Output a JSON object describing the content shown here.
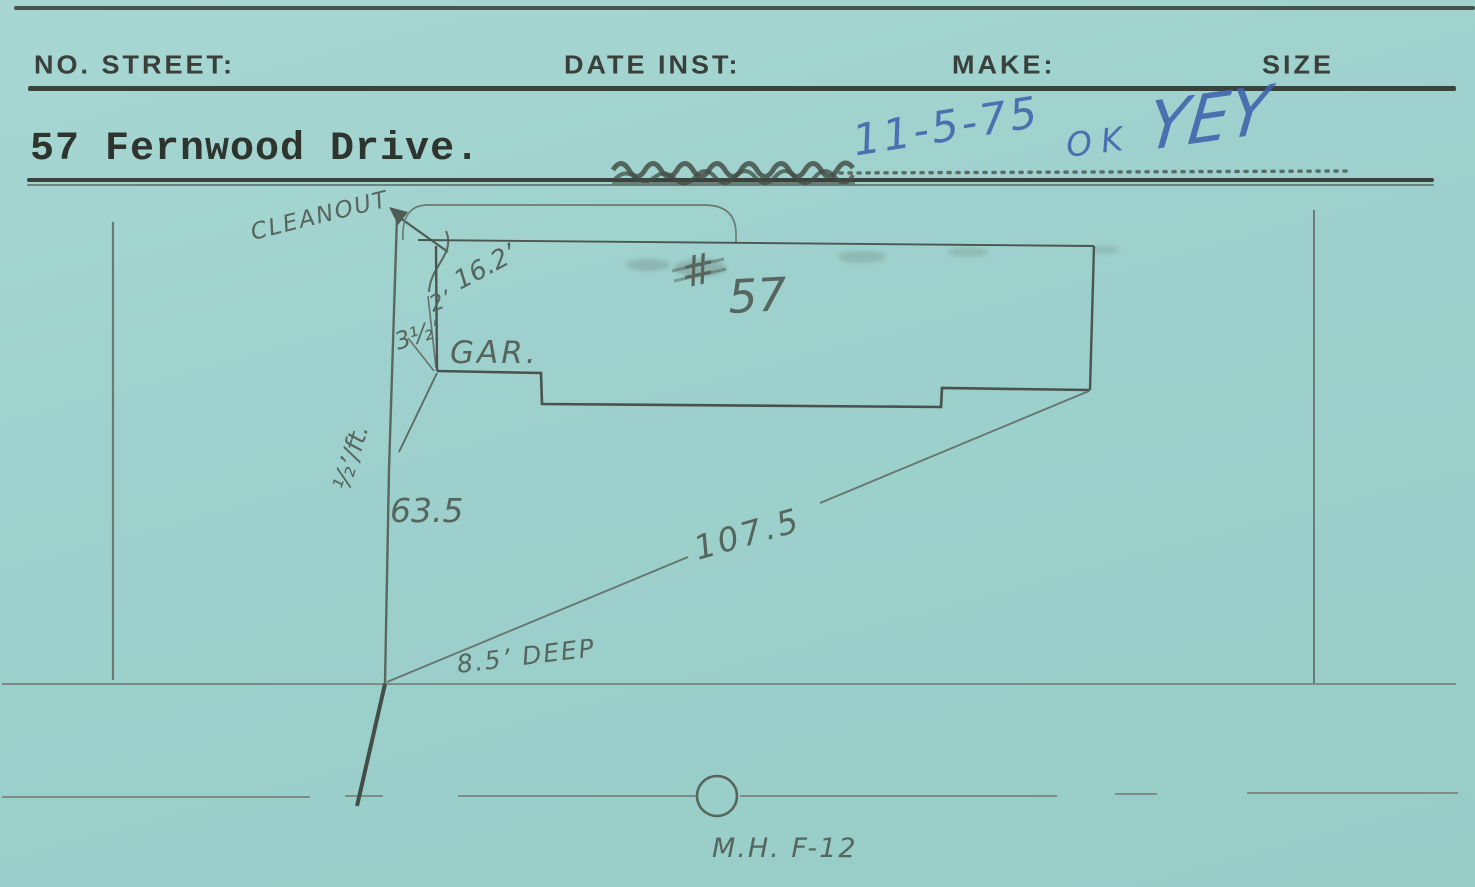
{
  "colors": {
    "card_bg": "#9ed1cd",
    "printed_ink": "#39403a",
    "pencil": "#5c6b63",
    "pencil_dark": "#49554e",
    "blue_pen": "#3f63ac"
  },
  "header": {
    "no_street": "NO. STREET:",
    "date_inst": "DATE INST:",
    "make": "MAKE:",
    "size": "SIZE"
  },
  "entry": {
    "address": "57 Fernwood Drive.",
    "date": "11-5-75",
    "ok": "OK",
    "initials": "YEY"
  },
  "diagram": {
    "cleanout": "CLEANOUT",
    "dim_16_2": "16.2’",
    "dim_2": "2’",
    "dim_3_5": "3½’",
    "garage": "GAR.",
    "hash": "#",
    "house_number": "57",
    "slope": "½’/ft.",
    "dim_63_5": "63.5",
    "dim_107_5": "107.5",
    "depth": "8.5’ DEEP",
    "manhole": "M.H. F-12"
  }
}
